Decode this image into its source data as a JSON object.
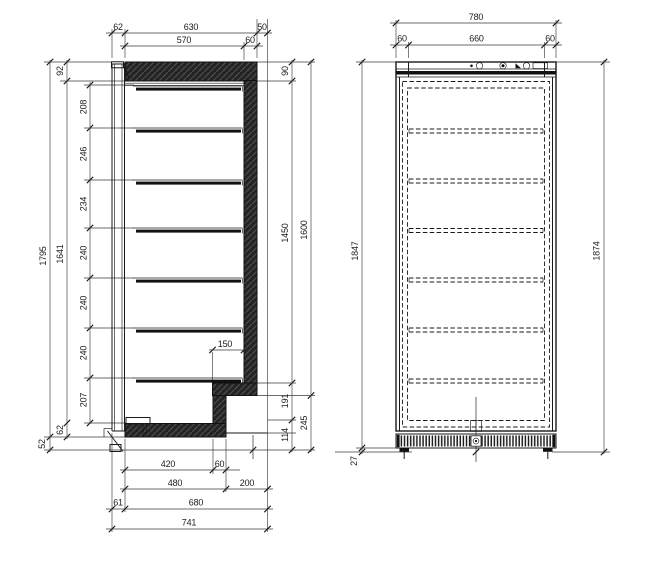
{
  "colors": {
    "line": "#1a1a1a",
    "dim_line": "#3a3a3a",
    "hatch_fill": "#242424",
    "hatch_stripe": "#4b4b4b",
    "background": "#ffffff"
  },
  "side": {
    "top": {
      "door_thickness": "62",
      "body_depth": "630",
      "rear_overhang": "50",
      "interior_depth": "570",
      "rear_wall": "60"
    },
    "left": {
      "overall_height": "1795",
      "interior_height": "1641",
      "top_panel": "92",
      "spacing_1": "208",
      "spacing_2": "246",
      "spacing_3": "234",
      "spacing_4": "240",
      "spacing_5": "240",
      "spacing_6": "240",
      "spacing_7": "207",
      "floor_thickness": "62",
      "plinth": "52"
    },
    "right": {
      "top_panel": "90",
      "wall_height": "1450",
      "outer_height": "1600",
      "step_depth": "150",
      "recess_upper": "191",
      "recess_height": "245",
      "recess_lower": "114"
    },
    "bottom": {
      "interior_floor": "420",
      "lower_wall": "60",
      "floor_span": "480",
      "recess_depth": "200",
      "door_thickness": "61",
      "body_depth": "680",
      "overall_depth": "741"
    }
  },
  "front": {
    "top": {
      "overall_width": "780",
      "hinge_left": "60",
      "center_span": "660",
      "hinge_right": "60"
    },
    "sides": {
      "height_left": "1847",
      "overall_height": "1874",
      "plinth": "27"
    }
  }
}
